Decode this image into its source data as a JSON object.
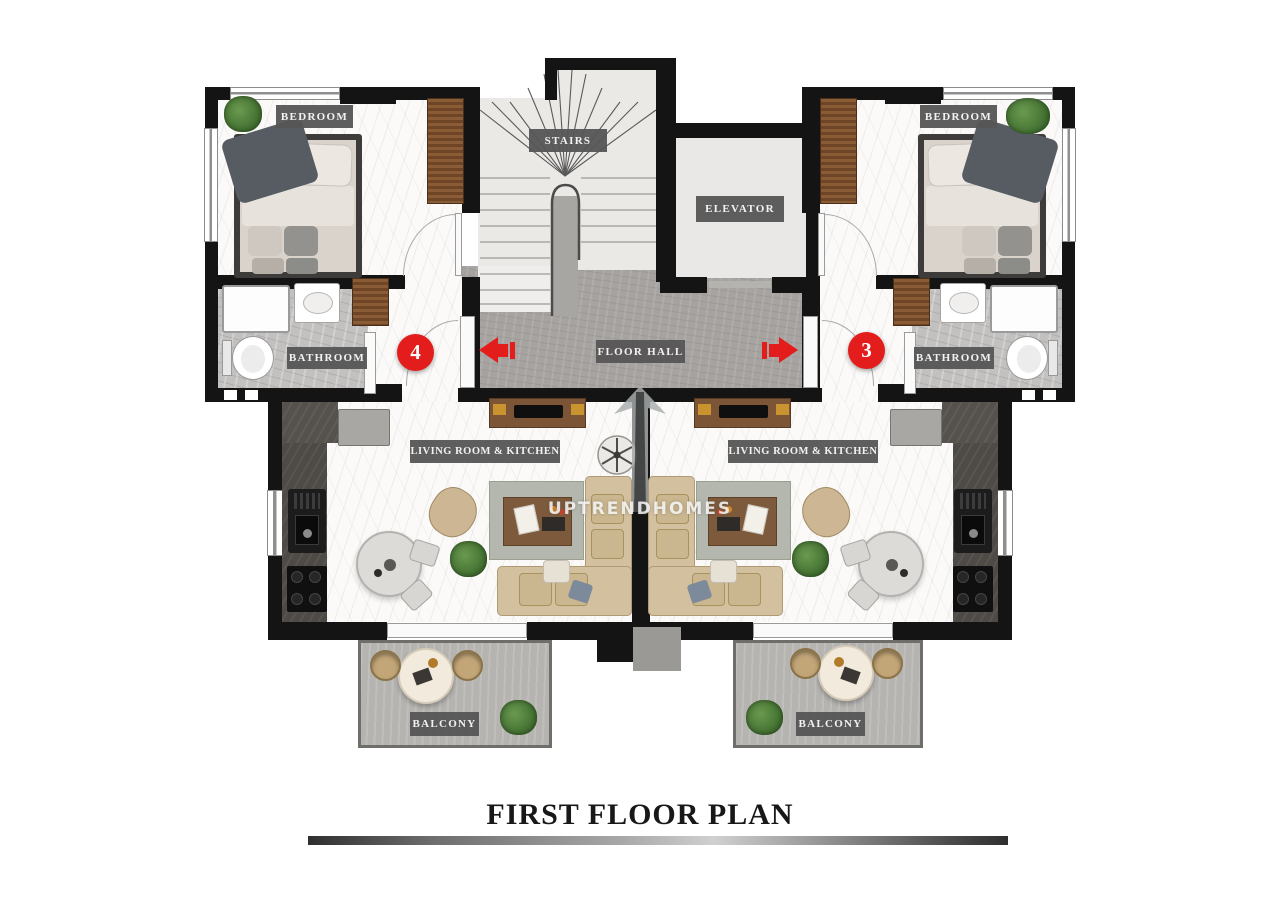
{
  "title": "FIRST FLOOR PLAN",
  "watermark": "UPTRENDHOMES",
  "labels": {
    "bedroom_left": "BEDROOM",
    "bedroom_right": "BEDROOM",
    "stairs": "STAIRS",
    "elevator": "ELEVATOR",
    "floor_hall": "FLOOR HALL",
    "bathroom_left": "BATHROOM",
    "bathroom_right": "BATHROOM",
    "living_left": "LIVING ROOM & KITCHEN",
    "living_right": "LIVING ROOM & KITCHEN",
    "balcony_left": "BALCONY",
    "balcony_right": "BALCONY"
  },
  "units": {
    "left": {
      "number": "4"
    },
    "right": {
      "number": "3"
    }
  },
  "icons": {
    "entry_arrow_left": "red-arrow-left",
    "entry_arrow_right": "red-arrow-right",
    "ceiling_fan": "ceiling-fan",
    "logo": "upward-arrow-ribbon"
  },
  "colors": {
    "wall": "#141414",
    "accent_red": "#e31c1c",
    "label_bg": "#565555",
    "label_text": "#f3f2f1",
    "hall_floor": "#a6a3a0",
    "stairs_floor": "#ebe9e6",
    "bathroom_floor": "#c3c1bf",
    "balcony_floor": "#b6b4b1",
    "marble": "#fbfaf8",
    "wood": "#7b5535",
    "wardrobe": "#8a5c36",
    "sofa": "#d3c09f",
    "plant": "#4e7a38",
    "counter": "#4e4a46",
    "title_text": "#181818"
  }
}
